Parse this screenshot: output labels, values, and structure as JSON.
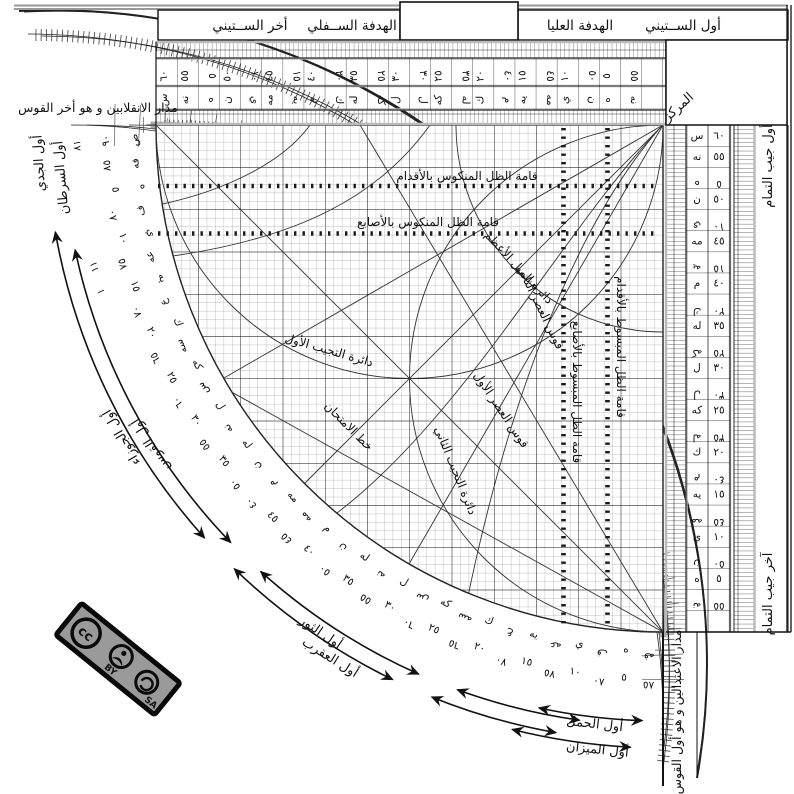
{
  "tabs": {
    "first_sixty": "أول الســتيني",
    "upper_sight": "الهدفة العليا",
    "lower_sight": "الهدفة الســفلي",
    "last_sixty": "أخر الســتيني"
  },
  "corner": {
    "center_label": "المركز"
  },
  "edge_labels": {
    "solstice_line": "مدار الانقلابين و هو أخر القوس",
    "equinox_line": "مدار الاعتدالين و هو أول القوس",
    "first_cosine": "أول جيب التمام",
    "last_cosine": "آخر جيب التمام"
  },
  "grid_labels": {
    "feet_reversed": "قامة الظل المنكوس بالأقدام",
    "digits_reversed": "قامة الظل المنكوس بالأصابع",
    "digits_extended": "قامة الظل المبسوط بالأصابع",
    "feet_extended": "قامة الظل المبسوط بالأقدام",
    "max_declination": "دائرة الميل الأعظم",
    "asr_second": "قوس العصر الثاني",
    "asr_first": "قوس العصر الأول",
    "sine_first": "دائرة التجيب الأول",
    "sine_second": "دائرة التجيب الثاني",
    "test_line": "خط الامتحان"
  },
  "zodiac": [
    {
      "label": "أول الجدي",
      "b": 86.5,
      "r": 621
    },
    {
      "label": "أول السرطان",
      "b": 85,
      "r": 600
    },
    {
      "label": "أول الجوزاء",
      "b": 60,
      "r": 621
    },
    {
      "label": "أول القوس",
      "b": 58,
      "r": 600
    },
    {
      "label": "أول الثور",
      "b": 34,
      "r": 616
    },
    {
      "label": "أول العقرب",
      "b": 32,
      "r": 632
    },
    {
      "label": "أول الحمل",
      "b": 6.5,
      "r": 607
    },
    {
      "label": "أول الميزان",
      "b": 6,
      "r": 632
    }
  ],
  "sparse_numbers": [
    {
      "t": "٨١",
      "b": 88
    },
    {
      "t": "١١",
      "b": 76
    },
    {
      "t": "١",
      "b": 73.5
    }
  ],
  "sexagesimal_scale": [
    {
      "n": "٦٠",
      "l": "س",
      "c": 0
    },
    {
      "n": "٥٥",
      "l": "نه",
      "c": 0
    },
    {
      "n": "٥",
      "l": "ه",
      "c": 1
    },
    {
      "n": "٥٠",
      "l": "ن",
      "c": 0
    },
    {
      "n": "١٠",
      "l": "ي",
      "c": 1
    },
    {
      "n": "٤٥",
      "l": "مه",
      "c": 0
    },
    {
      "n": "١٥",
      "l": "يه",
      "c": 1
    },
    {
      "n": "٤٠",
      "l": "م",
      "c": 0
    },
    {
      "n": "٢٠",
      "l": "ك",
      "c": 1
    },
    {
      "n": "٣٥",
      "l": "له",
      "c": 0
    },
    {
      "n": "٢٥",
      "l": "كه",
      "c": 1
    },
    {
      "n": "٣٠",
      "l": "ل",
      "c": 0
    },
    {
      "n": "٣٠",
      "l": "ل",
      "c": 1
    },
    {
      "n": "٢٥",
      "l": "كه",
      "c": 0
    },
    {
      "n": "٣٥",
      "l": "له",
      "c": 1
    },
    {
      "n": "٢٠",
      "l": "ك",
      "c": 0
    },
    {
      "n": "٤٠",
      "l": "م",
      "c": 1
    },
    {
      "n": "١٥",
      "l": "يه",
      "c": 0
    },
    {
      "n": "٤٥",
      "l": "مه",
      "c": 1
    },
    {
      "n": "١٠",
      "l": "ي",
      "c": 0
    },
    {
      "n": "٥٠",
      "l": "ن",
      "c": 1
    },
    {
      "n": "٥",
      "l": "ه",
      "c": 0
    },
    {
      "n": "٥٥",
      "l": "نه",
      "c": 1
    }
  ],
  "arc_scale": [
    {
      "n": "٩٠",
      "l": "ص",
      "c": 0
    },
    {
      "n": "٨٥",
      "l": "فه",
      "c": 0
    },
    {
      "n": "٥",
      "l": "ه",
      "c": 1
    },
    {
      "n": "٨٠",
      "l": "ف",
      "c": 0
    },
    {
      "n": "١٠",
      "l": "ي",
      "c": 1
    },
    {
      "n": "٧٥",
      "l": "عه",
      "c": 0
    },
    {
      "n": "١٥",
      "l": "يه",
      "c": 1
    },
    {
      "n": "٧٠",
      "l": "ع",
      "c": 0
    },
    {
      "n": "٢٠",
      "l": "ك",
      "c": 1
    },
    {
      "n": "٦٥",
      "l": "سه",
      "c": 0
    },
    {
      "n": "٢٥",
      "l": "كه",
      "c": 1
    },
    {
      "n": "٦٠",
      "l": "س",
      "c": 0
    },
    {
      "n": "٣٠",
      "l": "ل",
      "c": 1
    },
    {
      "n": "٥٥",
      "l": "نه",
      "c": 0
    },
    {
      "n": "٣٥",
      "l": "له",
      "c": 1
    },
    {
      "n": "٥٠",
      "l": "ن",
      "c": 0
    },
    {
      "n": "٤٠",
      "l": "م",
      "c": 1
    },
    {
      "n": "٤٥",
      "l": "مه",
      "c": 0
    },
    {
      "n": "٤٥",
      "l": "مه",
      "c": 1
    },
    {
      "n": "٤٠",
      "l": "م",
      "c": 0
    },
    {
      "n": "٥٠",
      "l": "ن",
      "c": 1
    },
    {
      "n": "٣٥",
      "l": "له",
      "c": 0
    },
    {
      "n": "٥٥",
      "l": "نه",
      "c": 1
    },
    {
      "n": "٣٠",
      "l": "ل",
      "c": 0
    },
    {
      "n": "٦٠",
      "l": "س",
      "c": 1
    },
    {
      "n": "٢٥",
      "l": "كه",
      "c": 0
    },
    {
      "n": "٦٥",
      "l": "سه",
      "c": 1
    },
    {
      "n": "٢٠",
      "l": "ك",
      "c": 0
    },
    {
      "n": "٧٠",
      "l": "ع",
      "c": 1
    },
    {
      "n": "١٥",
      "l": "يه",
      "c": 0
    },
    {
      "n": "٧٥",
      "l": "عه",
      "c": 1
    },
    {
      "n": "١٠",
      "l": "ي",
      "c": 0
    },
    {
      "n": "٨٠",
      "l": "ف",
      "c": 1
    },
    {
      "n": "٥",
      "l": "ه",
      "c": 0
    },
    {
      "n": "٨٥",
      "l": "فه",
      "c": 1
    }
  ],
  "cc": {
    "by": "BY",
    "sa": "SA"
  }
}
